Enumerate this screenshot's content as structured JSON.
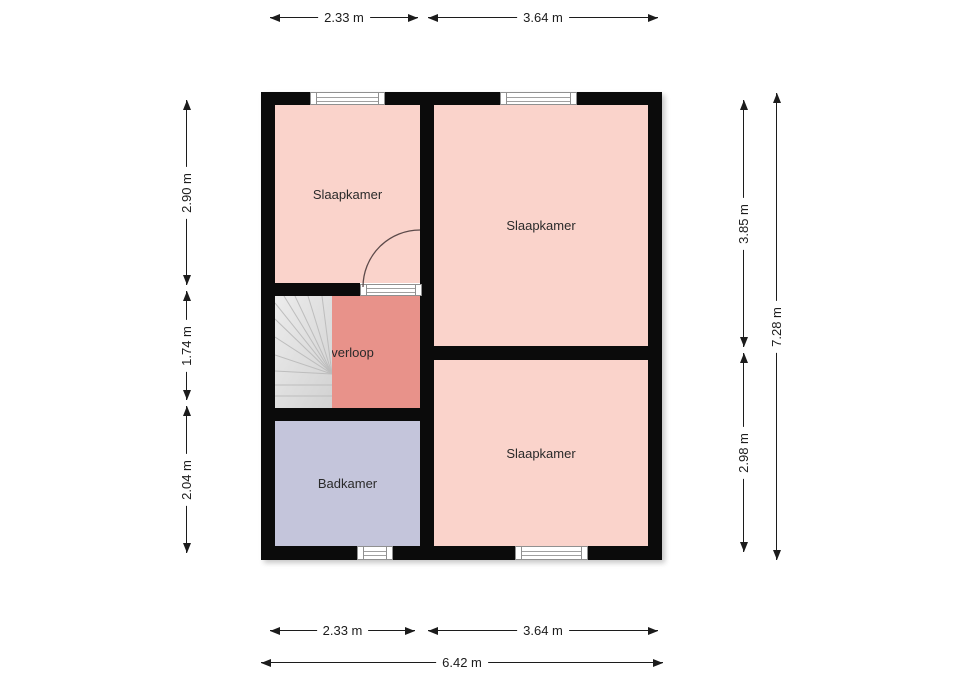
{
  "plan": {
    "rooms": [
      {
        "id": "slaapkamer-top-left",
        "label": "Slaapkamer"
      },
      {
        "id": "slaapkamer-top-right",
        "label": "Slaapkamer"
      },
      {
        "id": "overloop",
        "label": "Overloop"
      },
      {
        "id": "badkamer",
        "label": "Badkamer"
      },
      {
        "id": "slaapkamer-bottom-right",
        "label": "Slaapkamer"
      }
    ],
    "features": [
      "stairs",
      "door-arc",
      "windows"
    ]
  },
  "dimensions": {
    "top": [
      {
        "label": "2.33 m"
      },
      {
        "label": "3.64 m"
      }
    ],
    "left": [
      {
        "label": "2.90 m"
      },
      {
        "label": "1.74 m"
      },
      {
        "label": "2.04 m"
      }
    ],
    "right": [
      {
        "label": "3.85 m"
      },
      {
        "label": "2.98 m"
      },
      {
        "label": "7.28 m"
      }
    ],
    "bottom": [
      {
        "label": "2.33 m"
      },
      {
        "label": "3.64 m"
      },
      {
        "label": "6.42 m"
      }
    ]
  },
  "colors": {
    "wall": "#0b0b0b",
    "room_pink": "#fad3cb",
    "overloop_salmon": "#e8928a",
    "badkamer_lavender": "#c4c5db",
    "stairs_gray": "#dedede",
    "dimension_text": "#1c1c1c",
    "door_arc": "#5c4a4a",
    "window_frame": "#909090"
  }
}
